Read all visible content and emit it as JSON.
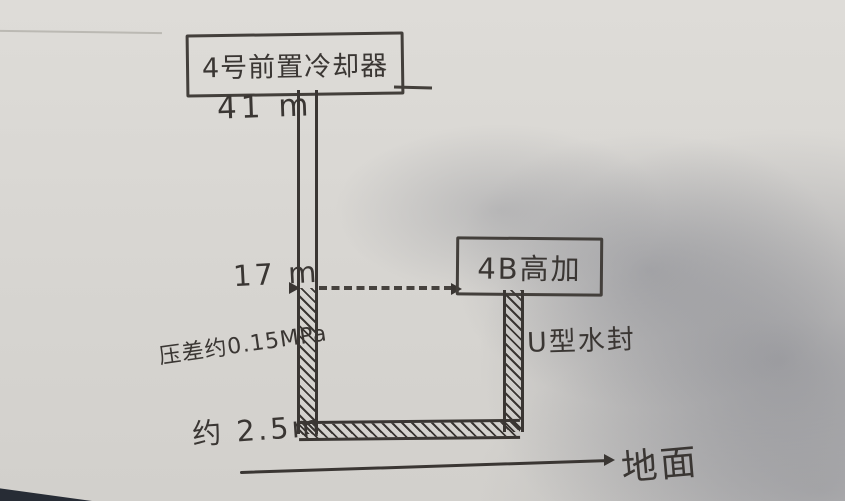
{
  "scene": {
    "description": "hand-drawn piping sketch on paper",
    "ink_color": "#3a3633",
    "paper_color": "#d8d6d2"
  },
  "labels": {
    "cooler": "4号前置冷却器",
    "height_top": "41 m",
    "height_mid": "17 m",
    "pressure": "压差约0.15MPa",
    "heater": "4B高加",
    "seal": "U型水封",
    "height_bottom": "约 2.5m",
    "ground": "地面"
  }
}
